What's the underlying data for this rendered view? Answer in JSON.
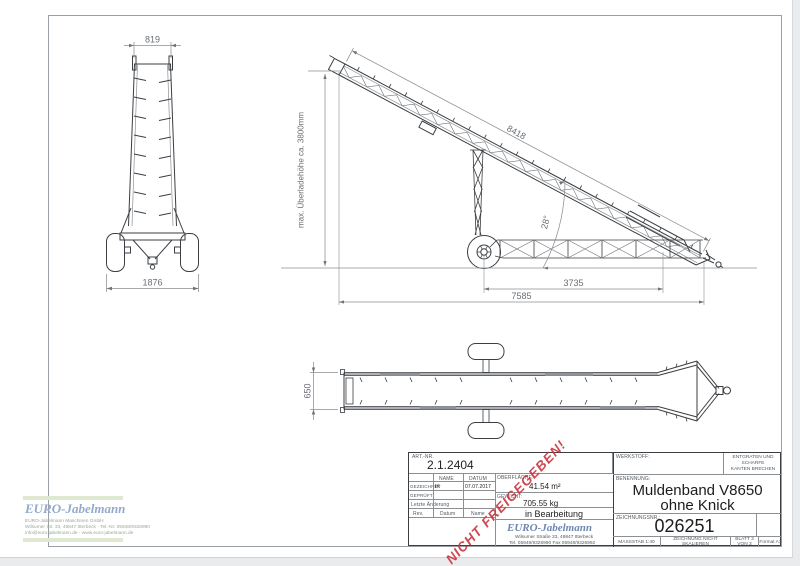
{
  "drawing": {
    "front_view": {
      "top_width": "819",
      "track_width": "1876"
    },
    "side_view": {
      "belt_length": "8418",
      "angle": "28°",
      "mid_span": "3735",
      "total_span": "7585",
      "unload_height": "max. Überladehöhe ca. 3800mm"
    },
    "top_view": {
      "belt_width": "650"
    }
  },
  "stamp": {
    "text": "NICHT FREIGEGEBEN!"
  },
  "title_block": {
    "art_nr_label": "ART.-NR.",
    "art_nr": "2.1.2404",
    "col_name": "NAME",
    "col_datum": "DATUM",
    "row_gezeichnet": "GEZEICHNET",
    "gezeichnet_name": "IK",
    "gezeichnet_datum": "07.07.2017",
    "row_geprueft": "GEPRÜFT",
    "letzte_aenderung": "Letzte Änderung",
    "rev_label": "Rev.",
    "datum_label": "Datum",
    "name_label": "Name",
    "oberflaeche_label": "OBERFLÄCHE:",
    "oberflaeche": "41.54 m²",
    "gewicht_label": "GEWICHT:",
    "gewicht": "705.55 kg",
    "status": "in Bearbeitung",
    "werkstoff_label": "WERKSTOFF:",
    "entgraten_line1": "ENTGRATEN UND SCHARFE",
    "entgraten_line2": "KANTEN BRECHEN",
    "benennung_label": "BENENNUNG:",
    "benennung_line1": "Muldenband V8650",
    "benennung_line2": "ohne Knick",
    "zeichnungsnr_label": "ZEICHNUNGSNR.:",
    "zeichnungsnr": "026251",
    "massstab": "MASSSTAB 1:40",
    "nicht_skalieren": "ZEICHNUNG NICHT SKALIEREN",
    "blatt": "BLATT 3 VON 3",
    "format": "Format A3",
    "logo_text": "EURO-Jabelmann",
    "logo_address1": "Wilsumer Straße 33, 49847 Itterbeck",
    "logo_address2": "Tel. 05948/9326990 Fax 05948/9326992"
  },
  "watermark": {
    "logo_text": "EURO-Jabelmann",
    "line1": "EURO-Jabelmann Maschinen GmbH",
    "line2": "Wilsumer Str. 33, 49847 Itterbeck · Tel.-Nr. 05948/9326990",
    "line3": "info@euro-jabelmann.de · www.euro-jabelmann.de"
  }
}
